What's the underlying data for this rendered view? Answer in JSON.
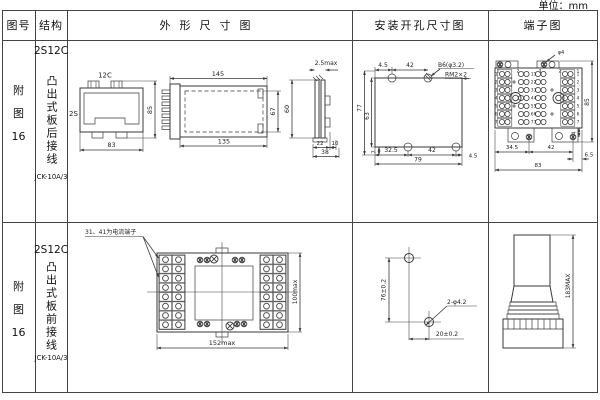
{
  "unit_label": "单位：mm",
  "header": {
    "figure": "图号",
    "structure": "结构",
    "outline": "外形尺寸图",
    "mounting": "安装开孔尺寸图",
    "terminal": "端子图"
  },
  "row1": {
    "figure_chars": [
      "附",
      "图",
      "16"
    ],
    "model": "2S12C",
    "structure_desc": "凸出式板后接线",
    "product": "JCK-10A/3",
    "front_view": {
      "top_label": "12C",
      "side_label": "2S",
      "height": "85",
      "width": "83"
    },
    "side_view": {
      "top_width": "145",
      "bottom_width": "135",
      "inner_height": "67"
    },
    "edge_view": {
      "thickness": "2.5max",
      "height": "60",
      "seg1": "22",
      "seg2": "10",
      "total": "38"
    },
    "mounting": {
      "top1": "4.5",
      "top2": "42",
      "hole_callout": "B6(φ3.2)",
      "thread_callout": "RM2×2",
      "left1": "77",
      "left2": "63",
      "bottom0": "7",
      "bottom1": "32.5",
      "bottom2": "42",
      "bottom3": "4.5",
      "bottom4": "79"
    },
    "terminal": {
      "screw_callout": "φ4",
      "bottom1": "34.5",
      "bottom2": "42",
      "bottom3": "6.5",
      "bottom4": "83",
      "right_height": "85",
      "foot": "4",
      "top_nums": [
        "1",
        "2",
        "3",
        "2",
        "1"
      ],
      "left_nums": [
        "1",
        "2",
        "3",
        "4",
        "5",
        "6",
        "7"
      ],
      "mid_nums": [
        "11",
        "22",
        "33",
        "44",
        "55",
        "66",
        "77"
      ],
      "right_nums": [
        "1",
        "2",
        "3",
        "4",
        "5",
        "6",
        "7"
      ]
    }
  },
  "row2": {
    "figure_chars": [
      "附",
      "图",
      "16"
    ],
    "model": "2S12C",
    "structure_desc": "凸出式板前接线",
    "product": "JCK-10A/3",
    "note": "31、41为电流端子",
    "plate": {
      "width": "152max",
      "height": "100max"
    },
    "mounting": {
      "vertical": "76±0.2",
      "horizontal": "20±0.2",
      "callout": "2-φ4.2"
    },
    "profile": {
      "height": "183MAX"
    }
  }
}
